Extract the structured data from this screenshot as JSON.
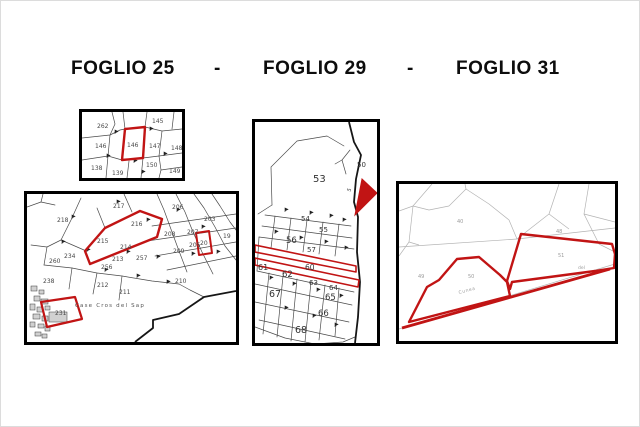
{
  "title": {
    "foglio25": "FOGLIO 25",
    "dash1": "-",
    "foglio29": "FOGLIO 29",
    "dash2": "-",
    "foglio31": "FOGLIO 31"
  },
  "colors": {
    "highlight_red": "#c11414",
    "line_dark": "#4a4a4a",
    "line_light": "#b3b3b3"
  },
  "foglio25_inset": {
    "parcels": [
      "262",
      "145",
      "146",
      "146",
      "147",
      "148",
      "138",
      "139",
      "150",
      "149"
    ]
  },
  "foglio25_main": {
    "parcels": [
      "218",
      "217",
      "216",
      "215",
      "234",
      "260",
      "214",
      "213",
      "257",
      "256",
      "238",
      "212",
      "211",
      "210",
      "206",
      "203",
      "207",
      "208",
      "209",
      "205",
      "20",
      "19",
      "231"
    ],
    "place_label": "Case Cros del Sap"
  },
  "foglio29": {
    "parcels": [
      "53",
      "50",
      "54",
      "55",
      "56",
      "57",
      "60",
      "61",
      "62",
      "63",
      "64",
      "65",
      "66",
      "67",
      "68",
      "5"
    ]
  },
  "foglio31": {
    "parcels": [
      "40",
      "48",
      "49",
      "50",
      "51"
    ],
    "road_label": "Cunea",
    "area_label": "del"
  }
}
